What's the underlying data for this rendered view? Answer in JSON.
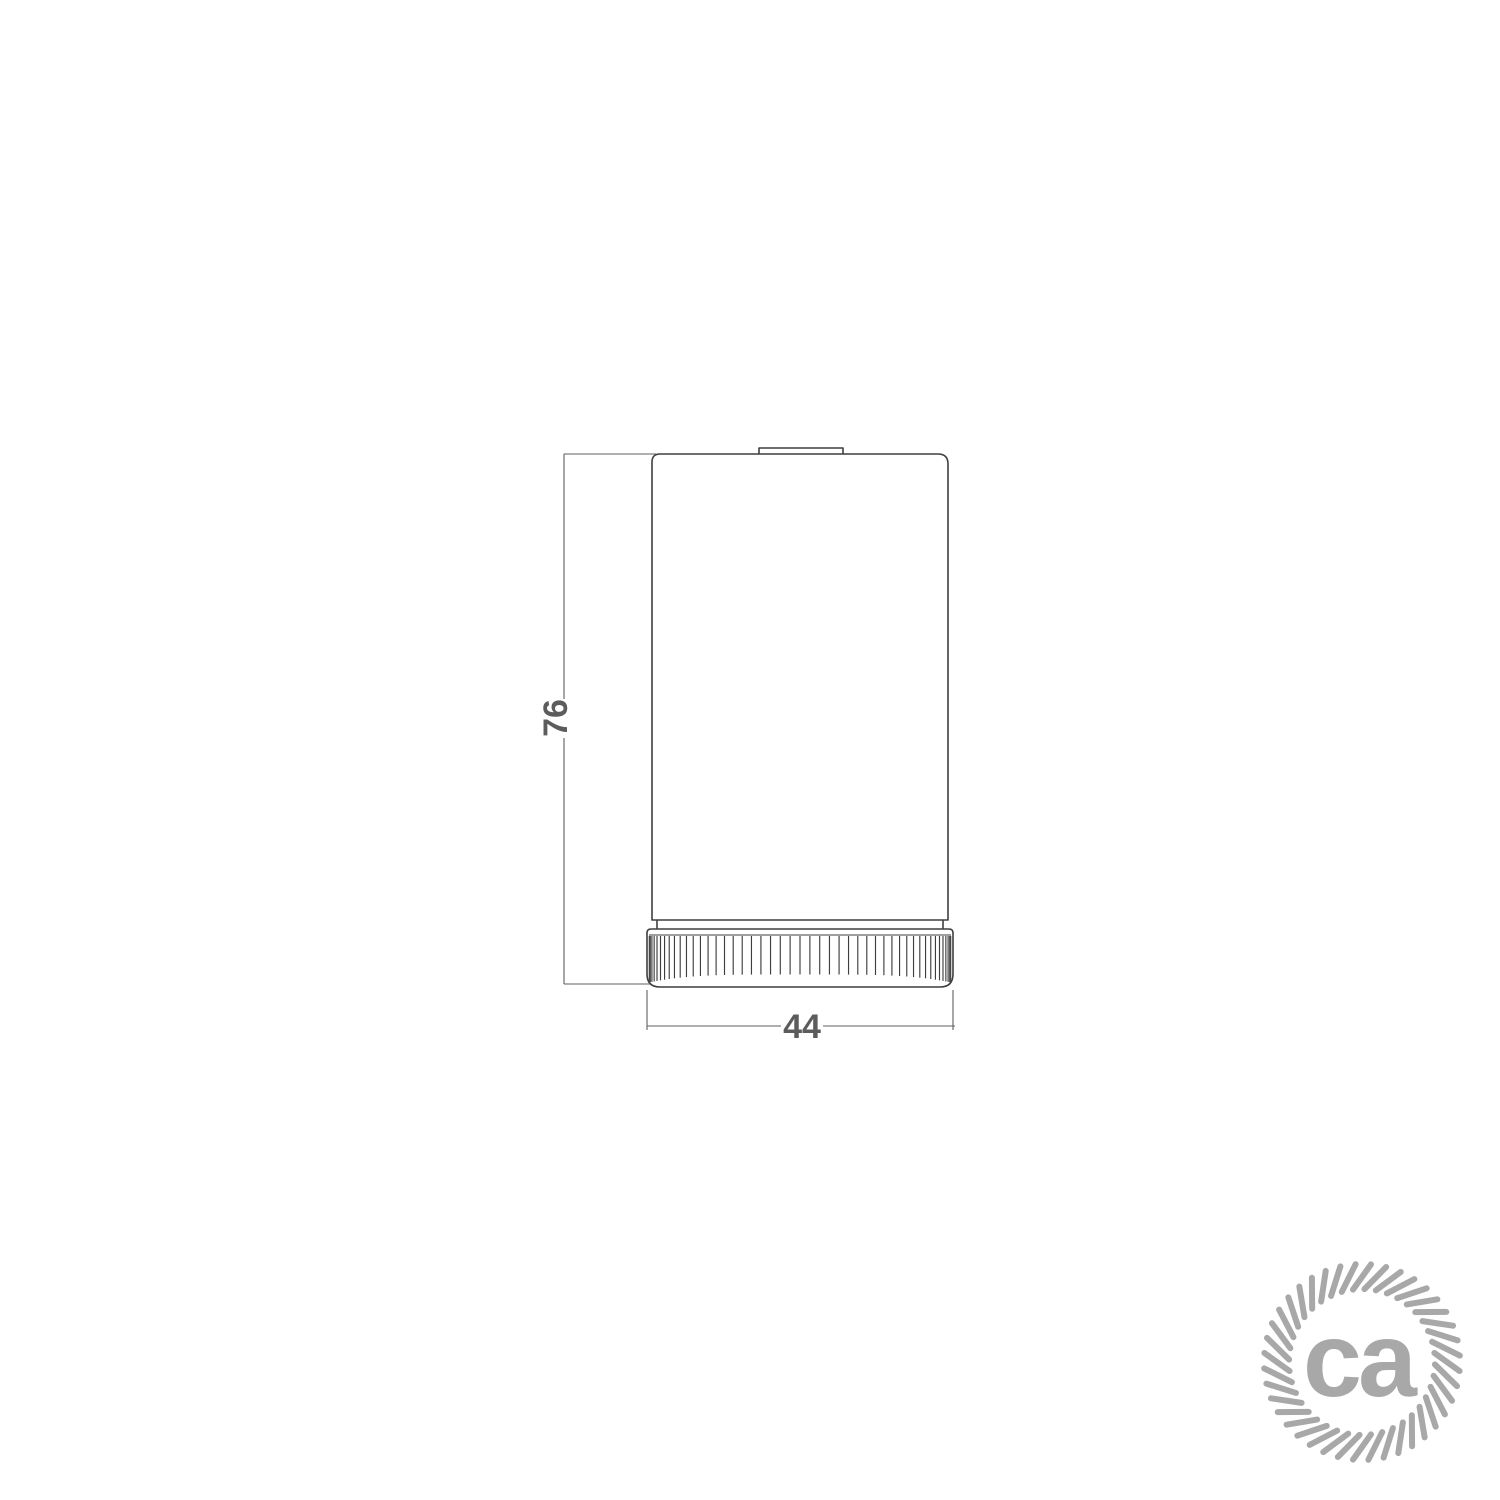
{
  "drawing": {
    "height_dimension": {
      "label": "76"
    },
    "width_dimension": {
      "label": "44"
    }
  },
  "logo": {
    "text": "ca",
    "color": "#a8a8a8"
  },
  "colors": {
    "outline": "#3f3f3f",
    "dimension_line": "#5f5f5f",
    "dimension_text": "#5c5c5c",
    "background": "#ffffff"
  }
}
